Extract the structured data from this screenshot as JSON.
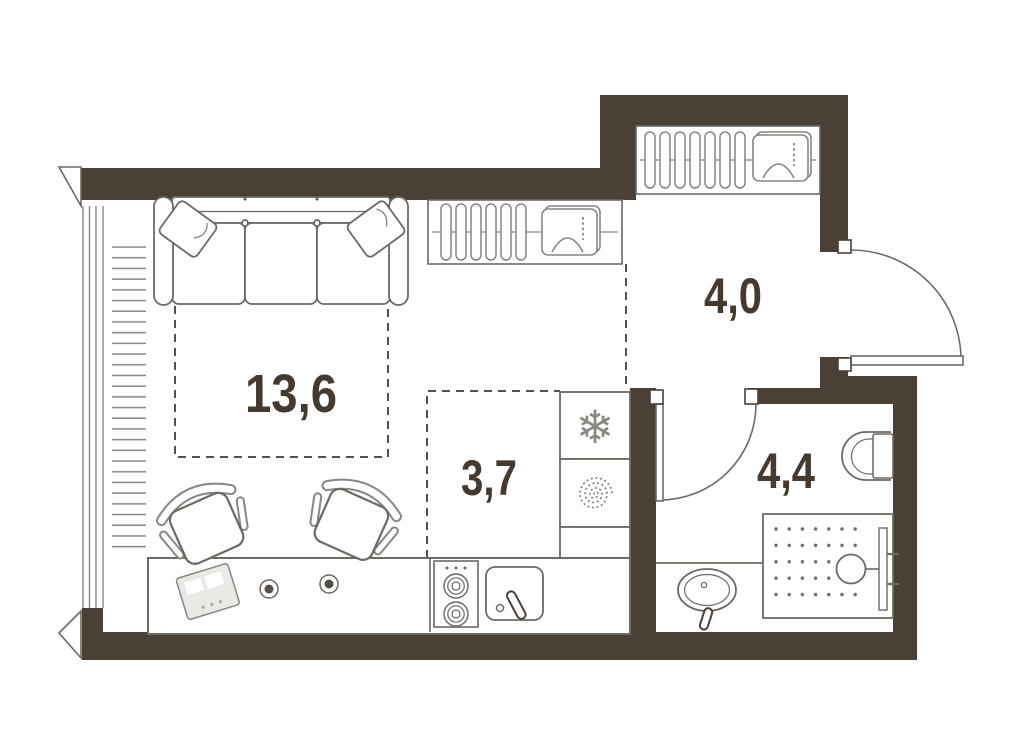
{
  "plan": {
    "kind": "apartment-floor-plan",
    "room_labels": [
      {
        "id": "living-room",
        "area": "13,6"
      },
      {
        "id": "kitchen",
        "area": "3,7"
      },
      {
        "id": "hallway",
        "area": "4,0"
      },
      {
        "id": "bathroom",
        "area": "4,4"
      }
    ],
    "icons": {
      "fridge_glyph": "❄",
      "washer": "spiral-icon",
      "wardrobe": "hanger-icon",
      "closet_box": "iron-icon"
    },
    "colors": {
      "wall": "#4b4036",
      "furniture_line": "#6d6963",
      "light_line": "#8a8680",
      "dashed_line": "#57504a",
      "label_text": "#453a30",
      "background": "#ffffff"
    }
  }
}
